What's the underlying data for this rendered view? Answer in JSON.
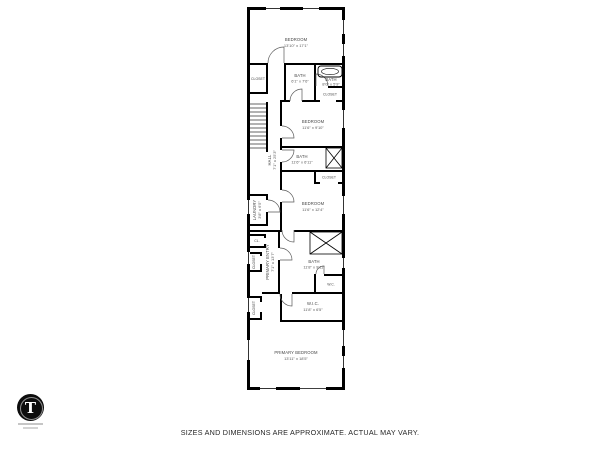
{
  "page": {
    "disclaimer": "SIZES AND DIMENSIONS ARE APPROXIMATE. ACTUAL MAY VARY.",
    "background_color": "#ffffff",
    "wall_color": "#000000",
    "label_color": "#474747"
  },
  "logo": {
    "monogram": "T",
    "disc_color": "#0d0d0d",
    "monogram_color": "#ffffff"
  },
  "floor_plan": {
    "rooms": [
      {
        "id": "bedroom-top",
        "label": "BEDROOM",
        "dims": "13'10\" x 17'1\""
      },
      {
        "id": "closet-top-left",
        "label": "CLOSET"
      },
      {
        "id": "bath-top-middle",
        "label": "BATH",
        "dims": "6'1\" x 7'6\""
      },
      {
        "id": "bath-top-right",
        "label": "BATH",
        "dims": "8'0\" x 5'9\""
      },
      {
        "id": "closet-top-right",
        "label": "CLOSET"
      },
      {
        "id": "bedroom-2",
        "label": "BEDROOM",
        "dims": "11'6\" x 9'10\""
      },
      {
        "id": "hall",
        "label": "HALL",
        "dims": "7'1\" x 25'3\""
      },
      {
        "id": "bath-middle",
        "label": "BATH",
        "dims": "11'6\" x 6'11\""
      },
      {
        "id": "closet-mid-right",
        "label": "CLOSET"
      },
      {
        "id": "laundry",
        "label": "LAUNDRY",
        "dims": "3'8\" x 6'5\""
      },
      {
        "id": "bedroom-3",
        "label": "BEDROOM",
        "dims": "11'6\" x 12'4\""
      },
      {
        "id": "closet-cl",
        "label": "CL."
      },
      {
        "id": "primary-entry",
        "label": "PRIMARY ENTRY",
        "dims": "7'1\" x 13'7\""
      },
      {
        "id": "closet-left",
        "label": "CLOSET"
      },
      {
        "id": "bath-primary",
        "label": "BATH",
        "dims": "11'8\" x 9'11\""
      },
      {
        "id": "wc",
        "label": "W.C."
      },
      {
        "id": "wic",
        "label": "W.I.C.",
        "dims": "11'8\" x 6'5\""
      },
      {
        "id": "closet-bottom-left",
        "label": "CLOSET"
      },
      {
        "id": "primary-bedroom",
        "label": "PRIMARY BEDROOM",
        "dims": "13'11\" x 18'5\""
      }
    ]
  }
}
